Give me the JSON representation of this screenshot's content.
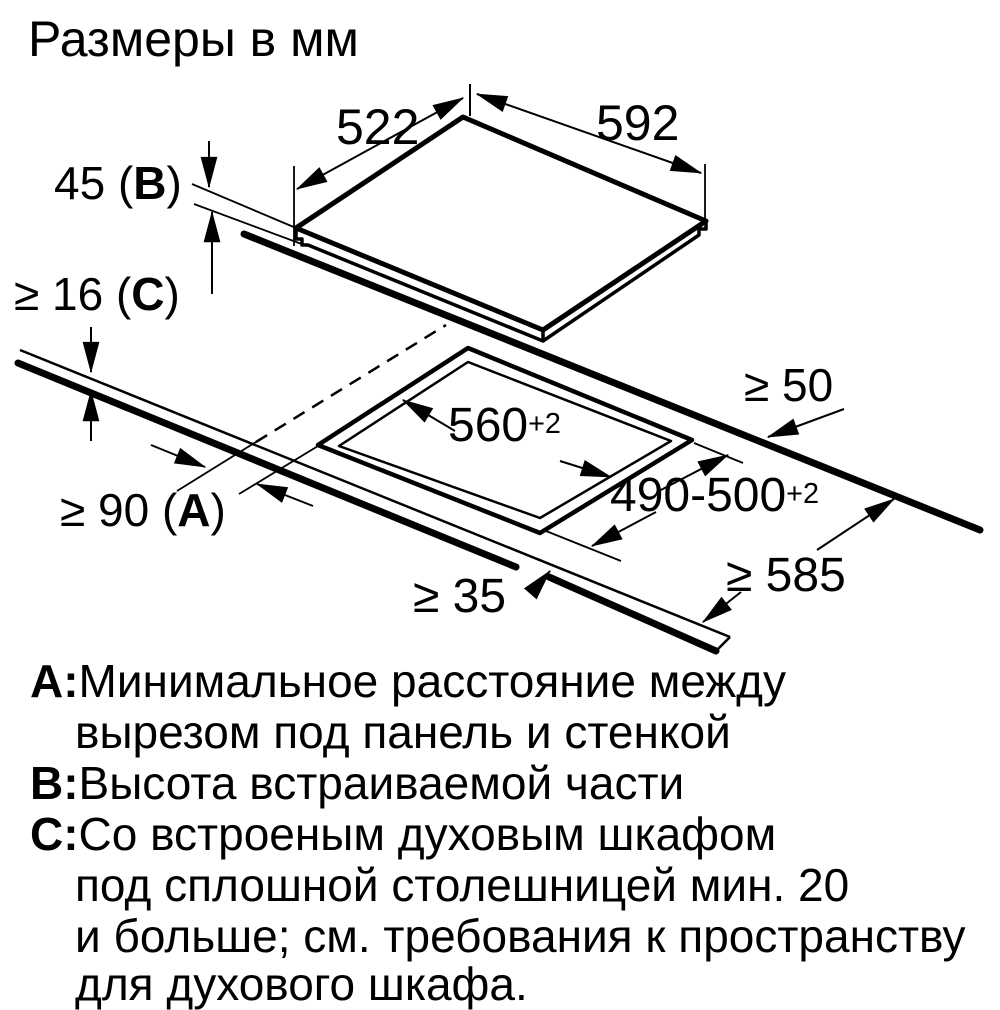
{
  "title": "Размеры в мм",
  "colors": {
    "line": "#000000",
    "background": "#ffffff"
  },
  "diagram": {
    "description": "cooktop-installation-cutout-diagram",
    "dims": {
      "width_top": "592",
      "depth_top": "522",
      "height_prefix": "45 (",
      "height_letter": "B",
      "height_suffix": ")",
      "worktop_thickness_prefix": "≥ 16 (",
      "worktop_thickness_letter": "C",
      "worktop_thickness_suffix": ")",
      "rear_clearance": "≥ 50",
      "cutout_width_value": "560",
      "cutout_width_tol": "+2",
      "cutout_depth_value": "490-500",
      "cutout_depth_tol": "+2",
      "side_clearance_prefix": "≥ 90 (",
      "side_clearance_letter": "A",
      "side_clearance_suffix": ")",
      "front_clearance": "≥ 35",
      "worktop_depth": "≥ 585"
    }
  },
  "legend": {
    "a_letter": "А:",
    "a_line1": "Минимальное расстояние между",
    "a_line2": "вырезом под панель и стенкой",
    "b_letter": "В:",
    "b_line1": "Высота встраиваемой части",
    "c_letter": "С:",
    "c_line1": "Со встроеным духовым шкафом",
    "c_line2": "под сплошной столешницей мин. 20",
    "c_line3": "и больше; см. требования к пространству",
    "c_line4": "для духового шкафа."
  }
}
